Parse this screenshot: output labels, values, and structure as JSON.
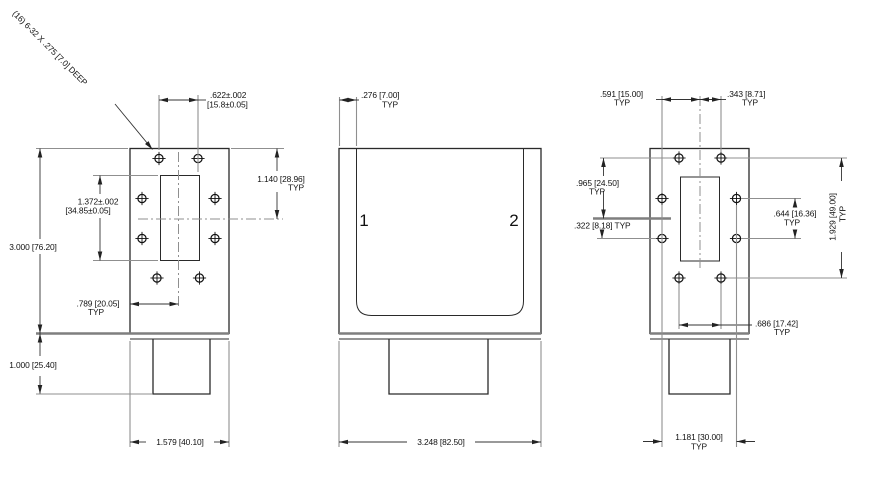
{
  "drawing": {
    "callout": "(16) 6-32 X .275 [7.0] DEEP",
    "typ": "TYP",
    "left_view": {
      "d622_in": ".622±.002",
      "d622_mm": "[15.8±0.05]",
      "d1140": "1.140 [28.96]",
      "d1372_in": "1.372±.002",
      "d1372_mm": "[34.85±0.05]",
      "d3000": "3.000 [76.20]",
      "d789": ".789 [20.05]",
      "d1000": "1.000 [25.40]",
      "d1579": "1.579 [40.10]"
    },
    "middle_view": {
      "d276": ".276 [7.00]",
      "port1": "1",
      "port2": "2",
      "d3248": "3.248 [82.50]"
    },
    "right_view": {
      "d591": ".591 [15.00]",
      "d343": ".343 [8.71]",
      "d965": ".965 [24.50]",
      "d322": ".322 [8.18] TYP",
      "d644": ".644 [16.36]",
      "d1929": "1.929 [49.00]",
      "d686": ".686 [17.42]",
      "d1181": "1.181 [30.00]"
    }
  }
}
